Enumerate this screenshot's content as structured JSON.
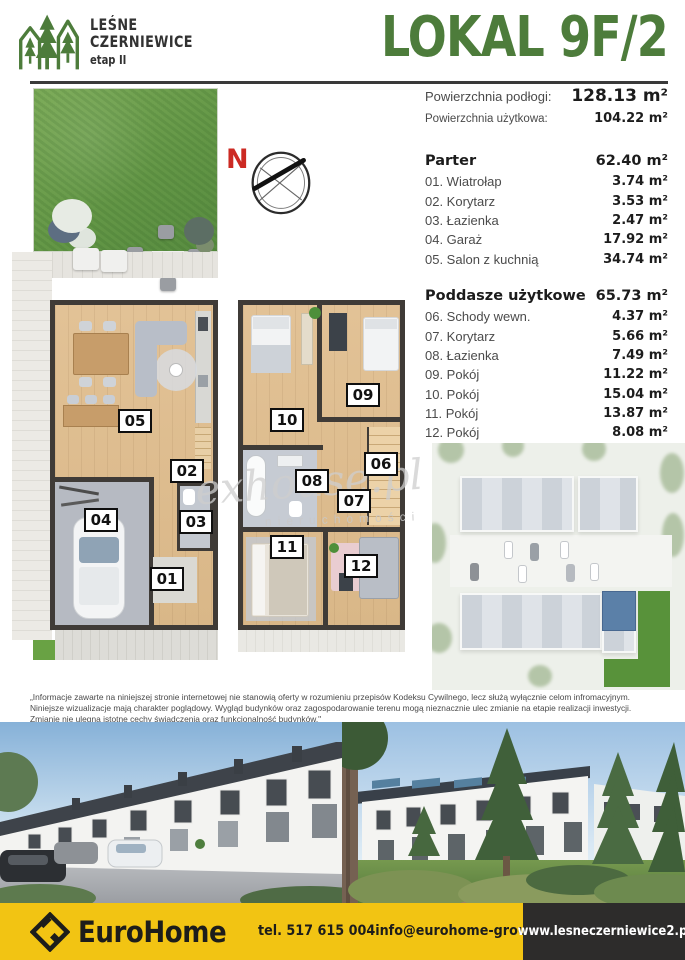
{
  "brand": {
    "line1": "LEŚNE",
    "line2": "CZERNIEWICE",
    "line3": "etap II"
  },
  "title": "LOKAL 9F/2",
  "summary": {
    "floor_label": "Powierzchnia podłogi:",
    "floor_value": "128.13 m²",
    "usable_label": "Powierzchnia użytkowa:",
    "usable_value": "104.22 m²"
  },
  "ground_floor": {
    "title": "Parter",
    "total": "62.40 m²",
    "rooms": [
      {
        "num": "01",
        "name": "Wiatrołap",
        "area": "3.74 m²"
      },
      {
        "num": "02",
        "name": "Korytarz",
        "area": "3.53 m²"
      },
      {
        "num": "03",
        "name": "Łazienka",
        "area": "2.47 m²"
      },
      {
        "num": "04",
        "name": "Garaż",
        "area": "17.92 m²"
      },
      {
        "num": "05",
        "name": "Salon z kuchnią",
        "area": "34.74 m²"
      }
    ]
  },
  "attic": {
    "title": "Poddasze użytkowe",
    "total": "65.73 m²",
    "rooms": [
      {
        "num": "06",
        "name": "Schody wewn.",
        "area": "4.37 m²"
      },
      {
        "num": "07",
        "name": "Korytarz",
        "area": "5.66 m²"
      },
      {
        "num": "08",
        "name": "Łazienka",
        "area": "7.49 m²"
      },
      {
        "num": "09",
        "name": "Pokój",
        "area": "11.22 m²"
      },
      {
        "num": "10",
        "name": "Pokój",
        "area": "15.04 m²"
      },
      {
        "num": "11",
        "name": "Pokój",
        "area": "13.87 m²"
      },
      {
        "num": "12",
        "name": "Pokój",
        "area": "8.08 m²"
      }
    ]
  },
  "compass": {
    "letter": "N"
  },
  "plan_badges": [
    {
      "num": "01",
      "x": 167,
      "y": 579
    },
    {
      "num": "02",
      "x": 187,
      "y": 471
    },
    {
      "num": "03",
      "x": 196,
      "y": 522
    },
    {
      "num": "04",
      "x": 101,
      "y": 520
    },
    {
      "num": "05",
      "x": 135,
      "y": 421
    },
    {
      "num": "06",
      "x": 381,
      "y": 464
    },
    {
      "num": "07",
      "x": 354,
      "y": 501
    },
    {
      "num": "08",
      "x": 312,
      "y": 481
    },
    {
      "num": "09",
      "x": 363,
      "y": 395
    },
    {
      "num": "10",
      "x": 287,
      "y": 420
    },
    {
      "num": "11",
      "x": 287,
      "y": 547
    },
    {
      "num": "12",
      "x": 361,
      "y": 566
    }
  ],
  "watermark": {
    "script": "exhouse.pl",
    "caption": "nieruchomości"
  },
  "disclaimer": "„Informacje zawarte na niniejszej stronie internetowej nie stanowią oferty w rozumieniu przepisów Kodeksu Cywilnego, lecz służą wyłącznie celom infromacyjnym. Niniejsze wizualizacje mają charakter poglądowy. Wygląd budynków oraz zagospodarowanie terenu mogą nieznacznie ulec zmianie na etapie realizacji inwestycji. Zmianie nie ulegną istotne cechy świadczenia oraz funkcjonalność budynków.\"",
  "footer": {
    "brand": "EuroHome",
    "phone": "tel. 517 615 004",
    "email": "info@eurohome-group.pl",
    "website": "www.lesneczerniewice2.pl"
  },
  "colors": {
    "accent_green": "#4d7c3b",
    "footer_yellow": "#f2c413",
    "footer_dark": "#2d2c2b",
    "highlight_blue": "#5b80a8"
  }
}
